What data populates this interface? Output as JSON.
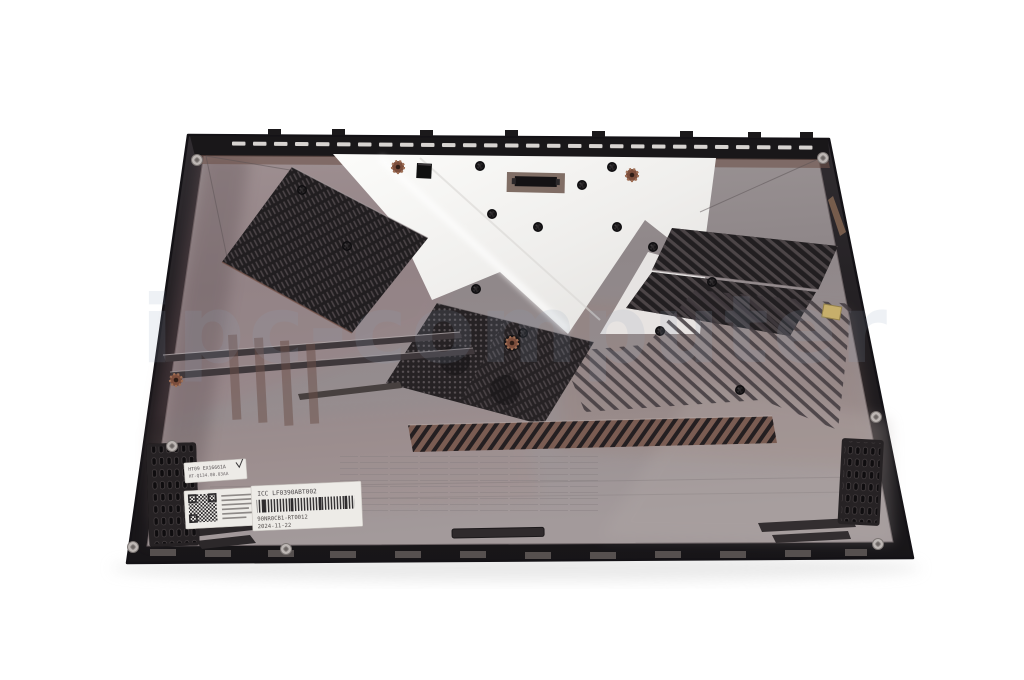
{
  "watermark": {
    "text": "ipc-computer"
  },
  "stickers": {
    "spec_label": {
      "line1": "HT09 EX16661A",
      "line2": "HT-Q134.08.03AA"
    },
    "qr_label": {
      "icon": "qr-code"
    },
    "part_label": {
      "title": "ICC LF0390ABT002",
      "icon": "barcode",
      "part_number": "90NR0CB1-RT0012",
      "date": "2024-11-22"
    }
  },
  "colors": {
    "background": "#ffffff",
    "edge": "#222023",
    "surface": "#948d8f",
    "bright": "#f4f3f1",
    "vent": "#211e20",
    "bronze": "#8a6355",
    "label": "#edebe7",
    "watermark": "#8ea3ba"
  }
}
